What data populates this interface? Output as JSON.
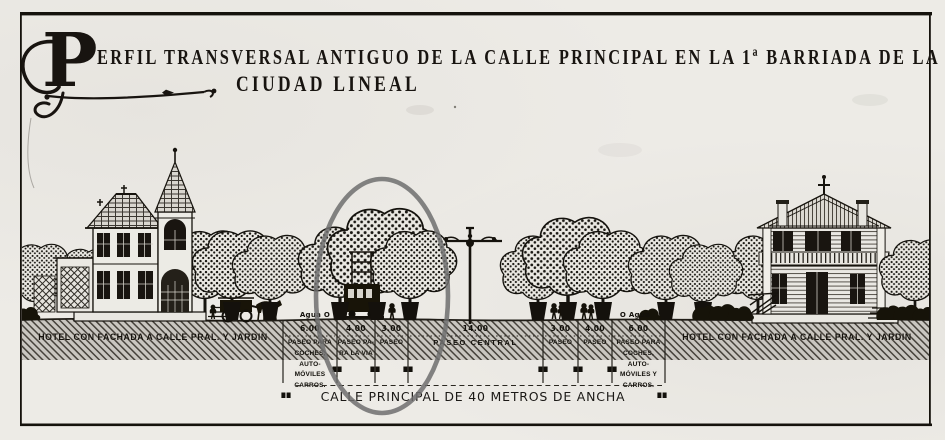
{
  "title": {
    "initial": "P",
    "line1_rest": "ERFIL TRANSVERSAL ANTIGUO DE LA CALLE PRINCIPAL EN LA 1ª BARRIADA DE LA",
    "line2": "CIUDAD LINEAL"
  },
  "bands": {
    "left_label": "HOTEL CON FACHADA A CALLE PRAL. Y JARDIN",
    "right_label": "HOTEL CON FACHADA A CALLE PRAL. Y JARDIN"
  },
  "sections": [
    {
      "width_m": "6.00",
      "label": "PASEO PARA\nCOCHES, AUTO-\nMÓVILES\nCARROS."
    },
    {
      "width_m": "4.00",
      "label": "PASEO PA-\nRA LA VIA"
    },
    {
      "width_m": "3.00",
      "label": "PASEO"
    },
    {
      "width_m": "14.00",
      "label": "PASEO CENTRAL"
    },
    {
      "width_m": "3.00",
      "label": "PASEO"
    },
    {
      "width_m": "4.00",
      "label": "PASEO"
    },
    {
      "width_m": "6.00",
      "label": "PASEO PARA\nCOCHES, AUTO-\nMÓVILES Y\nCARROS."
    }
  ],
  "utilities": {
    "water_left": "Agua O",
    "water_right": "O Agua"
  },
  "street_label": "CALLE PRINCIPAL DE 40 METROS DE ANCHA",
  "street_total_width_m": "40",
  "annotation": {
    "shape": "ellipse",
    "color": "#6f6f6f"
  },
  "colors": {
    "paper": "#edebe6",
    "ink": "#181410",
    "hatch_band": "#c9c6c0"
  }
}
